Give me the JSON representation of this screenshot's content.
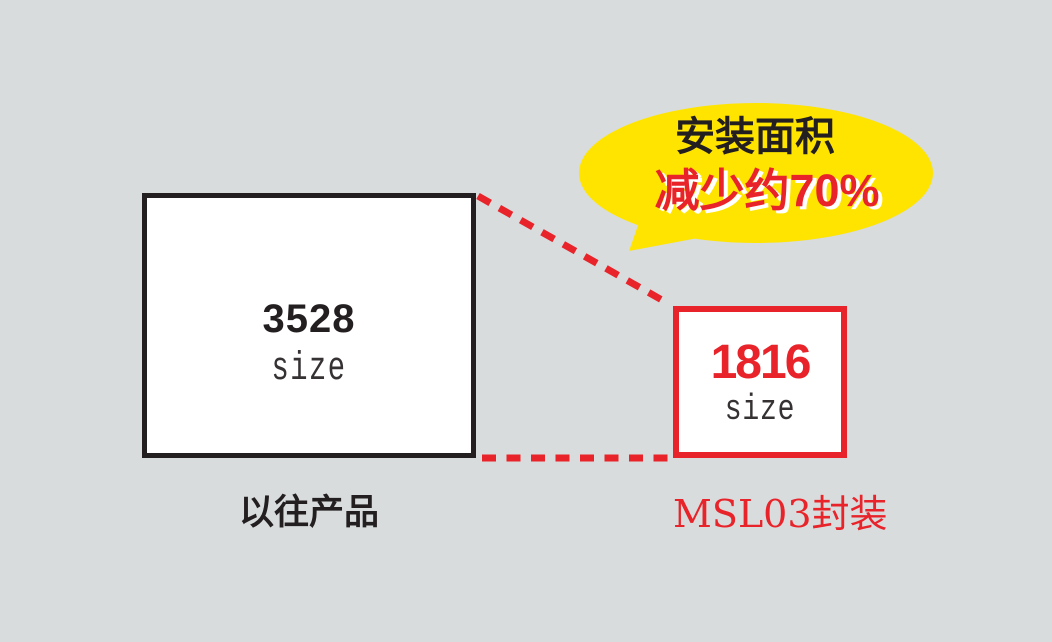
{
  "palette": {
    "background": "#d8dcdc",
    "black": "#231f20",
    "red": "#e8232a",
    "yellow": "#ffe400",
    "white": "#ffffff"
  },
  "bubble": {
    "line1": "安装面积",
    "line2": "减少约70%"
  },
  "old_product": {
    "size_value": "3528",
    "size_label": "size",
    "caption": "以往产品"
  },
  "new_product": {
    "size_value": "1816",
    "size_label": "size",
    "caption": "MSL03封装"
  }
}
